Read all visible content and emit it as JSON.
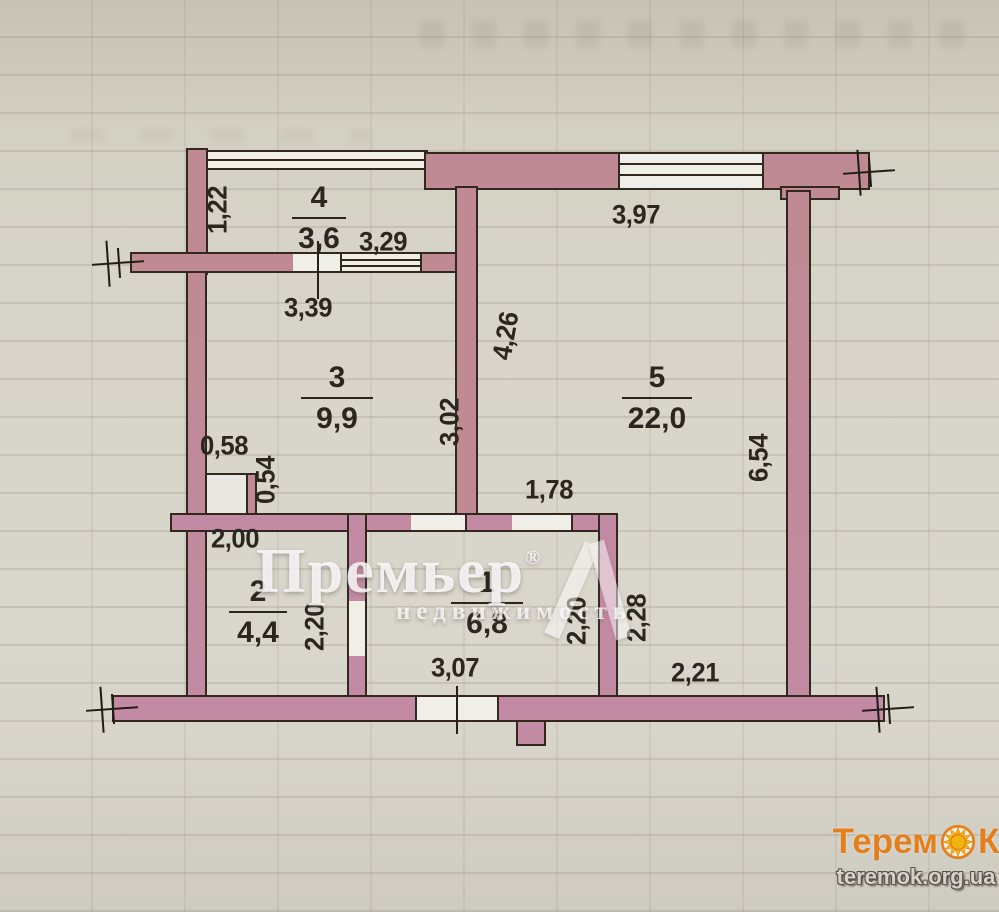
{
  "plan": {
    "rooms": [
      {
        "number": "4",
        "area": "3,6"
      },
      {
        "number": "3",
        "area": "9,9"
      },
      {
        "number": "5",
        "area": "22,0"
      },
      {
        "number": "2",
        "area": "4,4"
      },
      {
        "number": "1",
        "area": "6,8"
      }
    ],
    "dims": [
      {
        "v": "1,22"
      },
      {
        "v": "3,29"
      },
      {
        "v": "3,97"
      },
      {
        "v": "3,39"
      },
      {
        "v": "4,26"
      },
      {
        "v": "3,02"
      },
      {
        "v": "0,58"
      },
      {
        "v": "0,54"
      },
      {
        "v": "1,78"
      },
      {
        "v": "2,00"
      },
      {
        "v": "2,20"
      },
      {
        "v": "2,20"
      },
      {
        "v": "2,28"
      },
      {
        "v": "2,21"
      },
      {
        "v": "3,07"
      },
      {
        "v": "6,54"
      }
    ]
  },
  "watermark": {
    "brand": "Премьер",
    "reg": "®",
    "subtitle": "недвижимость"
  },
  "logo": {
    "brand_start": "Терем",
    "brand_end": "К",
    "url": "teremok.org.ua"
  },
  "colors": {
    "wall": "#bf8a93",
    "wall_bottom": "#c38ba3",
    "outline": "#32281e",
    "logo_orange": "#e8821c",
    "logo_sun": "#f7b70d"
  }
}
